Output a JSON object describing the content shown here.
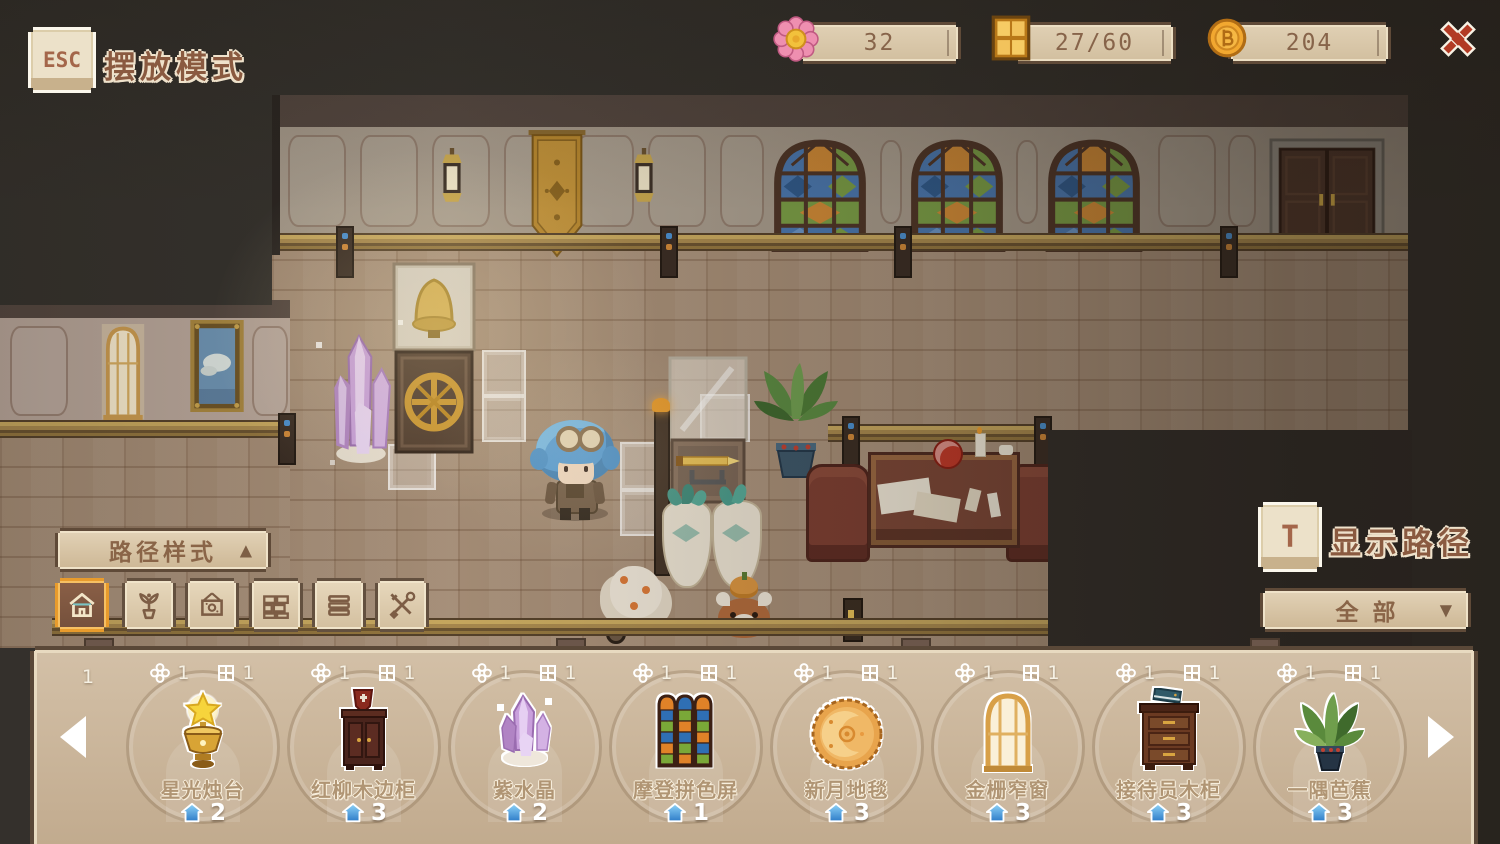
{
  "colors": {
    "accent_gold": "#e89b2c",
    "count_blue": "#3f8fdc",
    "close_red": "#b23b24",
    "ui_beige": "#d9c8ad",
    "ui_border_brown": "#5f4a38",
    "text_brown": "#8a6548"
  },
  "header": {
    "esc_key_label": "ESC",
    "mode_title": "摆放模式",
    "resources": [
      {
        "icon": "flower-icon",
        "value": "32"
      },
      {
        "icon": "window-icon",
        "value": "27/60"
      },
      {
        "icon": "coin-icon",
        "value": "204"
      }
    ],
    "close_icon": "close-icon"
  },
  "left_panel": {
    "path_style_label": "路径样式",
    "collapse_arrow": "▲",
    "tools": [
      {
        "icon": "building-icon",
        "selected": true
      },
      {
        "icon": "plant-icon",
        "selected": false
      },
      {
        "icon": "painting-icon",
        "selected": false
      },
      {
        "icon": "brick-icon",
        "selected": false
      },
      {
        "icon": "floor-icon",
        "selected": false
      },
      {
        "icon": "tools-icon",
        "selected": false
      }
    ]
  },
  "right_panel": {
    "t_key_label": "T",
    "show_path_label": "显示路径",
    "filter_label": "全部",
    "dropdown_arrow": "▼"
  },
  "item_bar": {
    "partial_left_cost": "1",
    "items": [
      {
        "name": "星光烛台",
        "flower_cost": "1",
        "window_cost": "1",
        "count": "2",
        "sprite": "starlight-candlestick"
      },
      {
        "name": "红柳木边柜",
        "flower_cost": "1",
        "window_cost": "1",
        "count": "3",
        "sprite": "red-willow-side-cabinet"
      },
      {
        "name": "紫水晶",
        "flower_cost": "1",
        "window_cost": "1",
        "count": "2",
        "sprite": "amethyst"
      },
      {
        "name": "摩登拼色屏",
        "flower_cost": "1",
        "window_cost": "1",
        "count": "1",
        "sprite": "modern-color-screen"
      },
      {
        "name": "新月地毯",
        "flower_cost": "1",
        "window_cost": "1",
        "count": "3",
        "sprite": "crescent-rug"
      },
      {
        "name": "金栅窄窗",
        "flower_cost": "1",
        "window_cost": "1",
        "count": "3",
        "sprite": "gold-grille-window"
      },
      {
        "name": "接待员木柜",
        "flower_cost": "1",
        "window_cost": "1",
        "count": "3",
        "sprite": "receptionist-cabinet"
      },
      {
        "name": "一隅芭蕉",
        "flower_cost": "1",
        "window_cost": "1",
        "count": "3",
        "sprite": "banana-plant"
      }
    ]
  }
}
